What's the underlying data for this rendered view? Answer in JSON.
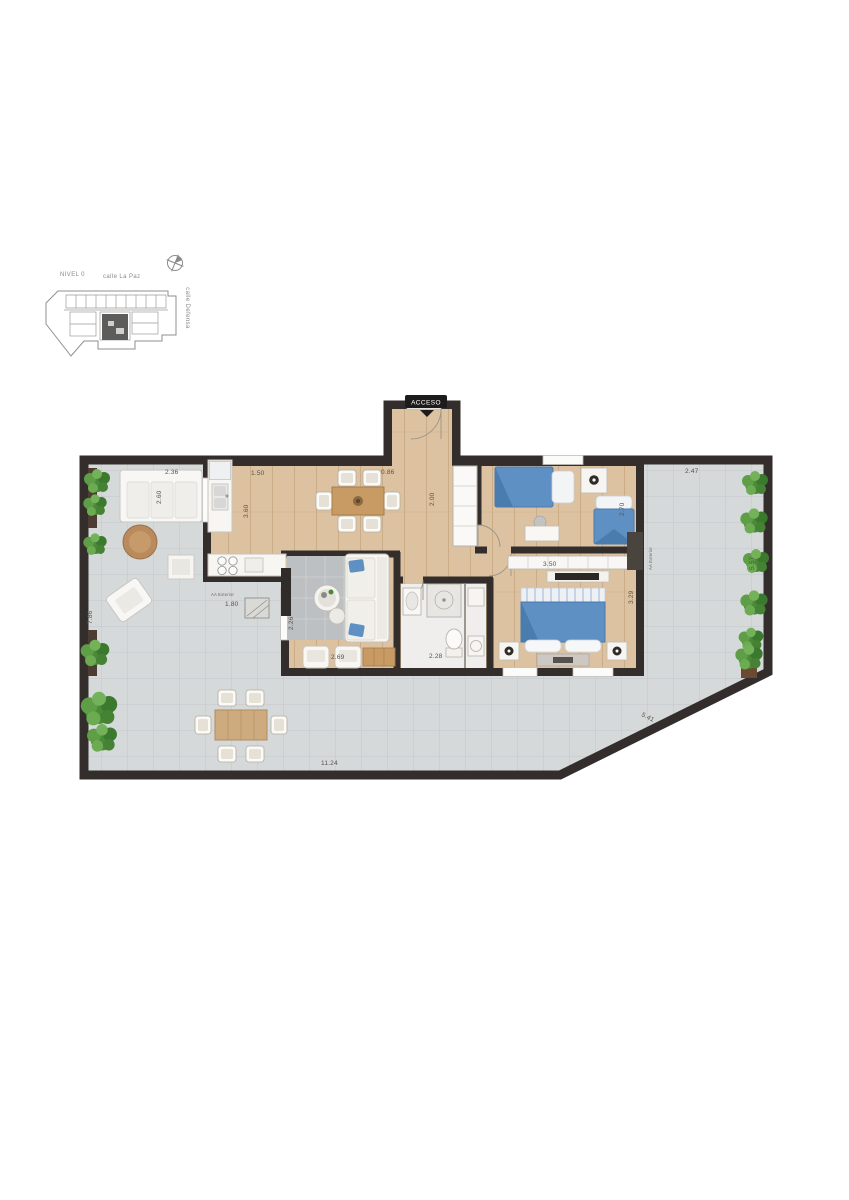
{
  "site_map": {
    "level": "NIVEL 0",
    "street_top": "calle La Paz",
    "street_right": "calle Defensa",
    "compass": "compass-icon",
    "highlight_color": "#5e5c5a"
  },
  "floor_plan": {
    "entrance_label": "ACCESO",
    "ac_label_left": "AA Exterior",
    "ac_label_right": "AA Exterior",
    "dimensions": {
      "terrace_top_left": "2.36",
      "kitchen_top": "1.50",
      "hall_top": "0.86",
      "terrace_right_top": "2.47",
      "terrace_right_height": "5.57",
      "terrace_left_height": "7.86",
      "sofa_zone": "2.60",
      "kitchen_depth": "3.60",
      "hall_depth": "2.00",
      "bedroom2_width": "2.70",
      "ac_left_dist": "1.80",
      "living_width": "2.69",
      "living_depth": "2.26",
      "bath_width": "2.28",
      "master_width": "3.50",
      "master_depth": "3.29",
      "terrace_bottom": "11.24",
      "terrace_diagonal": "5.41"
    },
    "colors": {
      "wall": "#332e2b",
      "wood_floor": "#dcc2a1",
      "terrace_tile": "#d6d9da",
      "bed_blue": "#5e90c4",
      "plant_green": "#4a8a39",
      "rug_gray": "#bcc0c3"
    }
  }
}
